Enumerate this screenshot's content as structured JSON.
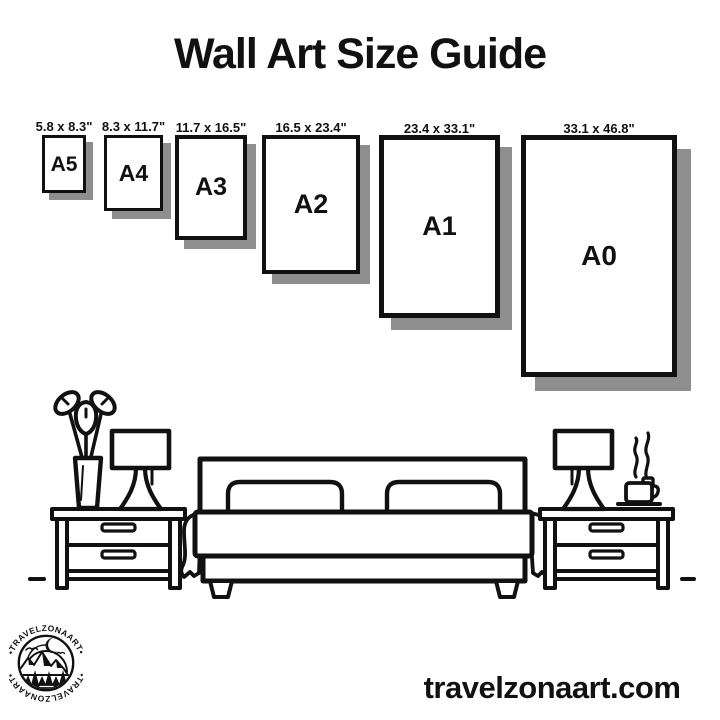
{
  "title": "Wall Art Size Guide",
  "sizes": [
    {
      "name": "A5",
      "dimensions": "5.8 x 8.3\"",
      "px": {
        "x": 42,
        "w": 44,
        "h": 58,
        "border": 3,
        "shadow": 7,
        "font": 21
      }
    },
    {
      "name": "A4",
      "dimensions": "8.3 x 11.7\"",
      "px": {
        "x": 104,
        "w": 59,
        "h": 76,
        "border": 3,
        "shadow": 8,
        "font": 23
      }
    },
    {
      "name": "A3",
      "dimensions": "11.7 x 16.5\"",
      "px": {
        "x": 175,
        "w": 72,
        "h": 105,
        "border": 4,
        "shadow": 9,
        "font": 25
      }
    },
    {
      "name": "A2",
      "dimensions": "16.5 x 23.4\"",
      "px": {
        "x": 262,
        "w": 98,
        "h": 139,
        "border": 4,
        "shadow": 10,
        "font": 27
      }
    },
    {
      "name": "A1",
      "dimensions": "23.4 x 33.1\"",
      "px": {
        "x": 379,
        "w": 121,
        "h": 183,
        "border": 5,
        "shadow": 12,
        "font": 27
      }
    },
    {
      "name": "A0",
      "dimensions": "33.1 x 46.8\"",
      "px": {
        "x": 521,
        "w": 156,
        "h": 242,
        "border": 5,
        "shadow": 14,
        "font": 28
      }
    }
  ],
  "illustration": {
    "items": [
      "flower-vase",
      "table-lamp-left",
      "nightstand-left",
      "bed-with-pillows",
      "table-lamp-right",
      "coffee-cup-steaming",
      "nightstand-right",
      "floor-line"
    ]
  },
  "logo": {
    "text_top": "•TRAVELZONAART•",
    "text_bottom": "•TRAVELZONAART•"
  },
  "footer": {
    "website": "travelzonaart.com"
  },
  "colors": {
    "ink": "#111111",
    "frame_shadow": "#8e8e8e",
    "background": "#ffffff"
  }
}
